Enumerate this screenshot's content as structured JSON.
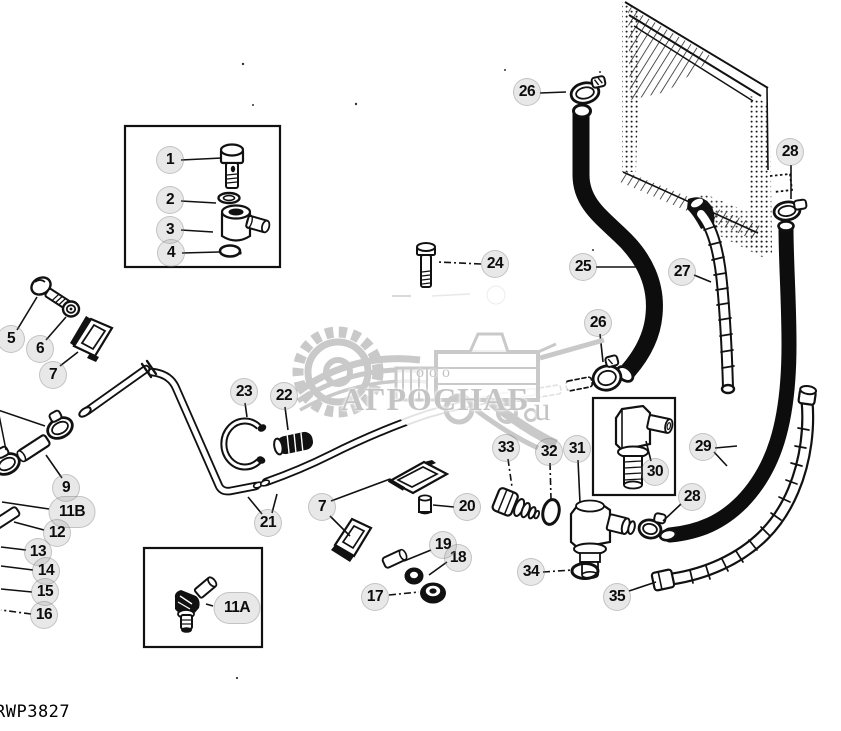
{
  "page": {
    "width": 841,
    "height": 731,
    "background": "#ffffff",
    "ink_color": "#111111"
  },
  "drawing_number": "RWP3827",
  "watermark": {
    "small_text": "ооо",
    "main_text": "АГРОСНАБ",
    "suffix_text": "u",
    "color": "#c4c4c4"
  },
  "callouts": [
    {
      "key": "1",
      "label": "1",
      "cx": 170,
      "cy": 160,
      "leaders": [
        {
          "x1": 181,
          "y1": 160,
          "x2": 222,
          "y2": 158
        }
      ]
    },
    {
      "key": "2",
      "label": "2",
      "cx": 170,
      "cy": 200,
      "leaders": [
        {
          "x1": 181,
          "y1": 201,
          "x2": 216,
          "y2": 203
        }
      ]
    },
    {
      "key": "3",
      "label": "3",
      "cx": 170,
      "cy": 230,
      "leaders": [
        {
          "x1": 181,
          "y1": 230,
          "x2": 213,
          "y2": 232
        }
      ]
    },
    {
      "key": "4",
      "label": "4",
      "cx": 171,
      "cy": 253,
      "leaders": [
        {
          "x1": 182,
          "y1": 253,
          "x2": 219,
          "y2": 252
        }
      ]
    },
    {
      "key": "5",
      "label": "5",
      "cx": 11,
      "cy": 339,
      "leaders": [
        {
          "x1": 17,
          "y1": 330,
          "x2": 37,
          "y2": 297
        }
      ]
    },
    {
      "key": "6",
      "label": "6",
      "cx": 40,
      "cy": 349,
      "leaders": [
        {
          "x1": 46,
          "y1": 340,
          "x2": 66,
          "y2": 317
        }
      ]
    },
    {
      "key": "7a",
      "label": "7",
      "cx": 53,
      "cy": 375,
      "leaders": [
        {
          "x1": 60,
          "y1": 366,
          "x2": 78,
          "y2": 352
        }
      ]
    },
    {
      "key": "9",
      "label": "9",
      "cx": 66,
      "cy": 488,
      "leaders": [
        {
          "x1": 62,
          "y1": 478,
          "x2": 46,
          "y2": 455
        }
      ]
    },
    {
      "key": "11B",
      "label": "11B",
      "cx": 72,
      "cy": 512,
      "wide": true,
      "leaders": [
        {
          "x1": 49,
          "y1": 509,
          "x2": 2,
          "y2": 502
        }
      ]
    },
    {
      "key": "12",
      "label": "12",
      "cx": 57,
      "cy": 533,
      "leaders": [
        {
          "x1": 44,
          "y1": 530,
          "x2": 14,
          "y2": 522
        }
      ]
    },
    {
      "key": "13",
      "label": "13",
      "cx": 38,
      "cy": 552,
      "leaders": [
        {
          "x1": 26,
          "y1": 550,
          "x2": 1,
          "y2": 547
        }
      ]
    },
    {
      "key": "14",
      "label": "14",
      "cx": 46,
      "cy": 571,
      "leaders": [
        {
          "x1": 33,
          "y1": 570,
          "x2": 1,
          "y2": 566
        }
      ]
    },
    {
      "key": "15",
      "label": "15",
      "cx": 45,
      "cy": 592,
      "leaders": [
        {
          "x1": 32,
          "y1": 592,
          "x2": 1,
          "y2": 589
        }
      ]
    },
    {
      "key": "16",
      "label": "16",
      "cx": 44,
      "cy": 615,
      "leaders": [
        {
          "x1": 31,
          "y1": 614,
          "x2": 1,
          "y2": 610,
          "dash": true
        }
      ]
    },
    {
      "key": "17",
      "label": "17",
      "cx": 375,
      "cy": 597,
      "leaders": [
        {
          "x1": 389,
          "y1": 595,
          "x2": 419,
          "y2": 592,
          "dash": true
        }
      ]
    },
    {
      "key": "18",
      "label": "18",
      "cx": 458,
      "cy": 558,
      "leaders": [
        {
          "x1": 447,
          "y1": 562,
          "x2": 429,
          "y2": 575
        }
      ]
    },
    {
      "key": "19",
      "label": "19",
      "cx": 443,
      "cy": 545,
      "leaders": [
        {
          "x1": 431,
          "y1": 550,
          "x2": 404,
          "y2": 561
        }
      ]
    },
    {
      "key": "20",
      "label": "20",
      "cx": 467,
      "cy": 507,
      "leaders": [
        {
          "x1": 454,
          "y1": 507,
          "x2": 433,
          "y2": 505
        }
      ]
    },
    {
      "key": "21",
      "label": "21",
      "cx": 268,
      "cy": 523,
      "leaders": [
        {
          "x1": 262,
          "y1": 514,
          "x2": 248,
          "y2": 497
        },
        {
          "x1": 272,
          "y1": 513,
          "x2": 277,
          "y2": 494
        }
      ]
    },
    {
      "key": "22",
      "label": "22",
      "cx": 284,
      "cy": 396,
      "leaders": [
        {
          "x1": 285,
          "y1": 407,
          "x2": 288,
          "y2": 430
        }
      ]
    },
    {
      "key": "23",
      "label": "23",
      "cx": 244,
      "cy": 392,
      "leaders": [
        {
          "x1": 245,
          "y1": 403,
          "x2": 247,
          "y2": 417
        }
      ]
    },
    {
      "key": "24",
      "label": "24",
      "cx": 495,
      "cy": 264,
      "leaders": [
        {
          "x1": 481,
          "y1": 264,
          "x2": 438,
          "y2": 262,
          "dash": true
        }
      ]
    },
    {
      "key": "25",
      "label": "25",
      "cx": 583,
      "cy": 267,
      "leaders": [
        {
          "x1": 596,
          "y1": 267,
          "x2": 637,
          "y2": 267
        }
      ]
    },
    {
      "key": "26a",
      "label": "26",
      "cx": 527,
      "cy": 92,
      "leaders": [
        {
          "x1": 540,
          "y1": 93,
          "x2": 566,
          "y2": 92
        }
      ]
    },
    {
      "key": "26b",
      "label": "26",
      "cx": 598,
      "cy": 323,
      "leaders": [
        {
          "x1": 600,
          "y1": 334,
          "x2": 603,
          "y2": 362
        }
      ]
    },
    {
      "key": "27",
      "label": "27",
      "cx": 682,
      "cy": 272,
      "leaders": [
        {
          "x1": 694,
          "y1": 275,
          "x2": 711,
          "y2": 282
        }
      ]
    },
    {
      "key": "28a",
      "label": "28",
      "cx": 790,
      "cy": 152,
      "leaders": [
        {
          "x1": 791,
          "y1": 165,
          "x2": 791,
          "y2": 199
        }
      ]
    },
    {
      "key": "28b",
      "label": "28",
      "cx": 692,
      "cy": 497,
      "leaders": [
        {
          "x1": 681,
          "y1": 504,
          "x2": 663,
          "y2": 521
        }
      ]
    },
    {
      "key": "29",
      "label": "29",
      "cx": 703,
      "cy": 447,
      "leaders": [
        {
          "x1": 715,
          "y1": 448,
          "x2": 737,
          "y2": 446
        },
        {
          "x1": 714,
          "y1": 452,
          "x2": 727,
          "y2": 466
        }
      ]
    },
    {
      "key": "30",
      "label": "30",
      "cx": 655,
      "cy": 472,
      "leaders": [
        {
          "x1": 651,
          "y1": 461,
          "x2": 646,
          "y2": 441
        }
      ]
    },
    {
      "key": "31",
      "label": "31",
      "cx": 577,
      "cy": 449,
      "leaders": [
        {
          "x1": 578,
          "y1": 460,
          "x2": 580,
          "y2": 503
        }
      ]
    },
    {
      "key": "32",
      "label": "32",
      "cx": 549,
      "cy": 452,
      "leaders": [
        {
          "x1": 550,
          "y1": 463,
          "x2": 551,
          "y2": 499,
          "dash": true
        }
      ]
    },
    {
      "key": "33",
      "label": "33",
      "cx": 506,
      "cy": 448,
      "leaders": [
        {
          "x1": 508,
          "y1": 459,
          "x2": 512,
          "y2": 487,
          "dash": true
        }
      ]
    },
    {
      "key": "34",
      "label": "34",
      "cx": 531,
      "cy": 572,
      "leaders": [
        {
          "x1": 543,
          "y1": 572,
          "x2": 572,
          "y2": 570,
          "dash": true
        }
      ]
    },
    {
      "key": "35",
      "label": "35",
      "cx": 617,
      "cy": 597,
      "leaders": [
        {
          "x1": 629,
          "y1": 591,
          "x2": 656,
          "y2": 582
        }
      ]
    },
    {
      "key": "11A",
      "label": "11A",
      "cx": 237,
      "cy": 608,
      "wide": true,
      "leaders": [
        {
          "x1": 213,
          "y1": 606,
          "x2": 206,
          "y2": 604
        }
      ]
    },
    {
      "key": "7b",
      "label": "7",
      "cx": 322,
      "cy": 507,
      "leaders": [
        {
          "x1": 331,
          "y1": 501,
          "x2": 390,
          "y2": 479
        },
        {
          "x1": 330,
          "y1": 516,
          "x2": 350,
          "y2": 536
        }
      ]
    }
  ]
}
